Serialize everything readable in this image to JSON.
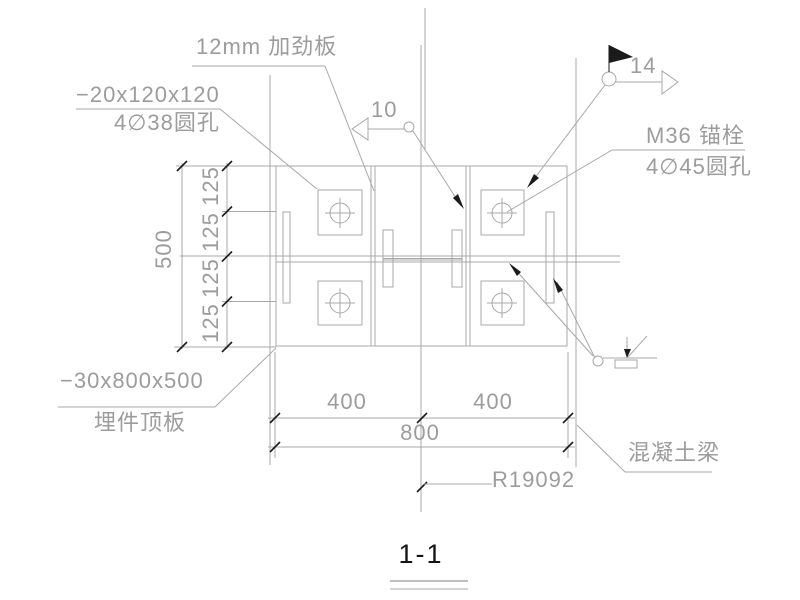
{
  "labels": {
    "stiffener_plate": "12mm 加劲板",
    "washer_plate_size": "−20x120x120",
    "washer_plate_holes": "4∅38圆孔",
    "anchor_bolt": "M36 锚栓",
    "anchor_bolt_holes": "4∅45圆孔",
    "embed_plate_size": "−30x800x500",
    "embed_plate_name": "埋件顶板",
    "concrete_beam": "混凝土梁",
    "radius_ref": "R19092"
  },
  "weld_marks": {
    "left_size": "10",
    "right_size": "14"
  },
  "dimensions": {
    "total_height": "500",
    "height_segments": [
      "125",
      "125",
      "125",
      "125"
    ],
    "left_width": "400",
    "right_width": "400",
    "total_width": "800"
  },
  "section_title": "1-1",
  "colors": {
    "line_gray": "#a8a8a8",
    "text_gray": "#9c9c9c",
    "accent_black": "#1b1b1b",
    "background": "#ffffff"
  }
}
